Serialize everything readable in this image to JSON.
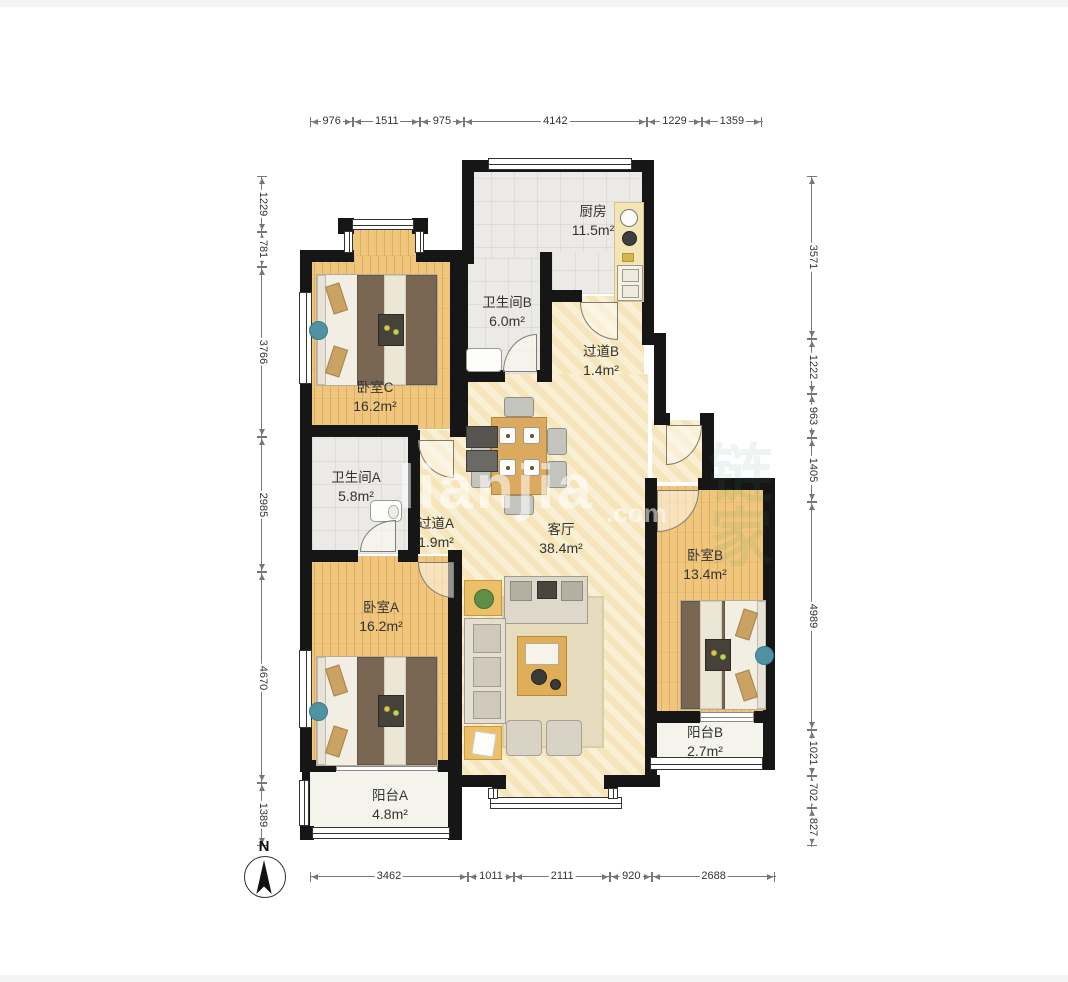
{
  "floorplan": {
    "north_label": "N",
    "watermark_primary": "lianjia",
    "watermark_suffix": ".com",
    "watermark_secondary": "链家",
    "rooms": [
      {
        "id": "kitchen",
        "label": "厨房",
        "area": "11.5m²"
      },
      {
        "id": "bathroom-b",
        "label": "卫生间B",
        "area": "6.0m²"
      },
      {
        "id": "hallway-b",
        "label": "过道B",
        "area": "1.4m²"
      },
      {
        "id": "bedroom-c",
        "label": "卧室C",
        "area": "16.2m²"
      },
      {
        "id": "bathroom-a",
        "label": "卫生间A",
        "area": "5.8m²"
      },
      {
        "id": "hallway-a",
        "label": "过道A",
        "area": "1.9m²"
      },
      {
        "id": "living-room",
        "label": "客厅",
        "area": "38.4m²"
      },
      {
        "id": "bedroom-b",
        "label": "卧室B",
        "area": "13.4m²"
      },
      {
        "id": "bedroom-a",
        "label": "卧室A",
        "area": "16.2m²"
      },
      {
        "id": "balcony-b",
        "label": "阳台B",
        "area": "2.7m²"
      },
      {
        "id": "balcony-a",
        "label": "阳台A",
        "area": "4.8m²"
      }
    ],
    "dimensions_mm": {
      "top": [
        "976",
        "1511",
        "975",
        "4142",
        "1229",
        "1359"
      ],
      "bottom": [
        "3462",
        "1011",
        "2111",
        "920",
        "2688"
      ],
      "left": [
        "1229",
        "781",
        "3766",
        "2985",
        "4670",
        "1389"
      ],
      "right": [
        "3571",
        "1222",
        "963",
        "1405",
        "4989",
        "1021",
        "702",
        "827"
      ]
    },
    "colors": {
      "wall": "#161616",
      "wood_floor": "#f0c67d",
      "tile_floor": "#eceae6",
      "living_floor": "#f7e9c2",
      "balcony_floor": "#f5f4ec",
      "dimension_line": "#777777",
      "label_text": "#333333"
    }
  }
}
